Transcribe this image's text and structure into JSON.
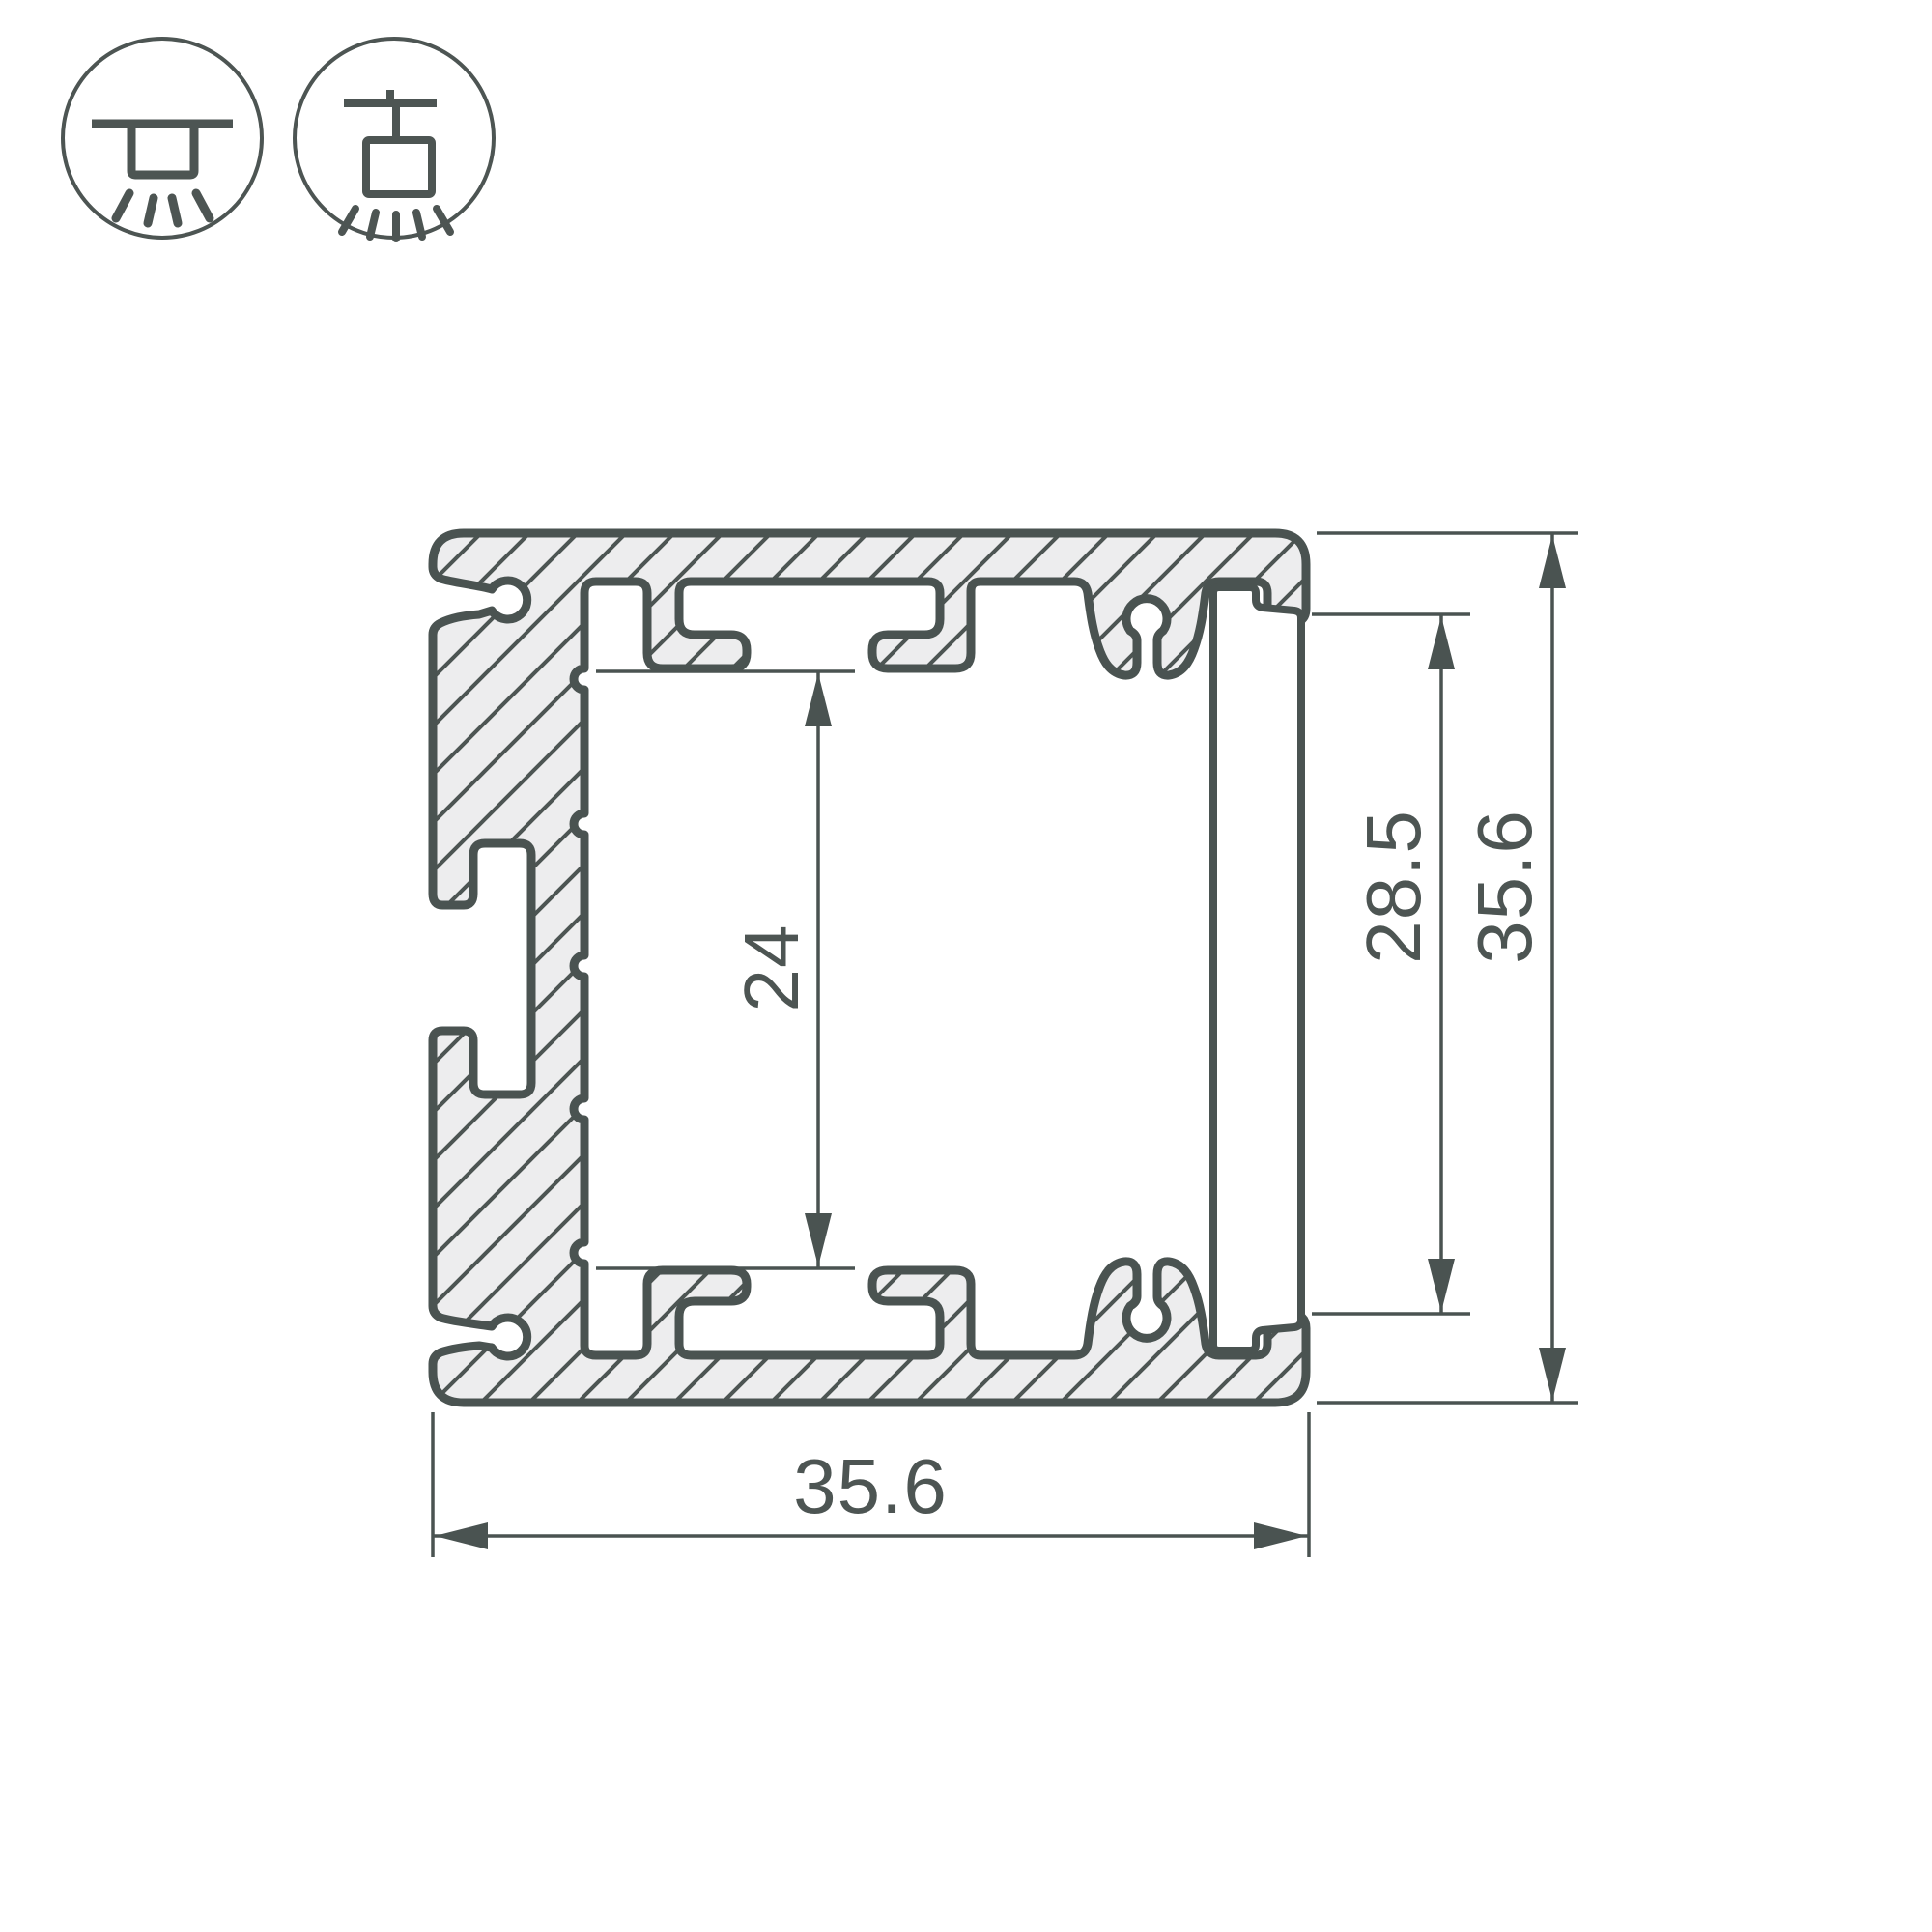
{
  "drawing": {
    "title": "aluminium-led-profile-cross-section",
    "dimensions": {
      "inner_height": "24",
      "diffuser_height": "28.5",
      "outer_height": "35.6",
      "outer_width": "35.6"
    },
    "icons": {
      "icon1": "surface-ceiling-mount-light-icon",
      "icon2": "suspended-pendant-mount-light-icon"
    },
    "colors": {
      "line": "#4a5351",
      "hatch_fill": "#ededee",
      "background": "#ffffff",
      "dimension_text": "#4d5553"
    }
  }
}
